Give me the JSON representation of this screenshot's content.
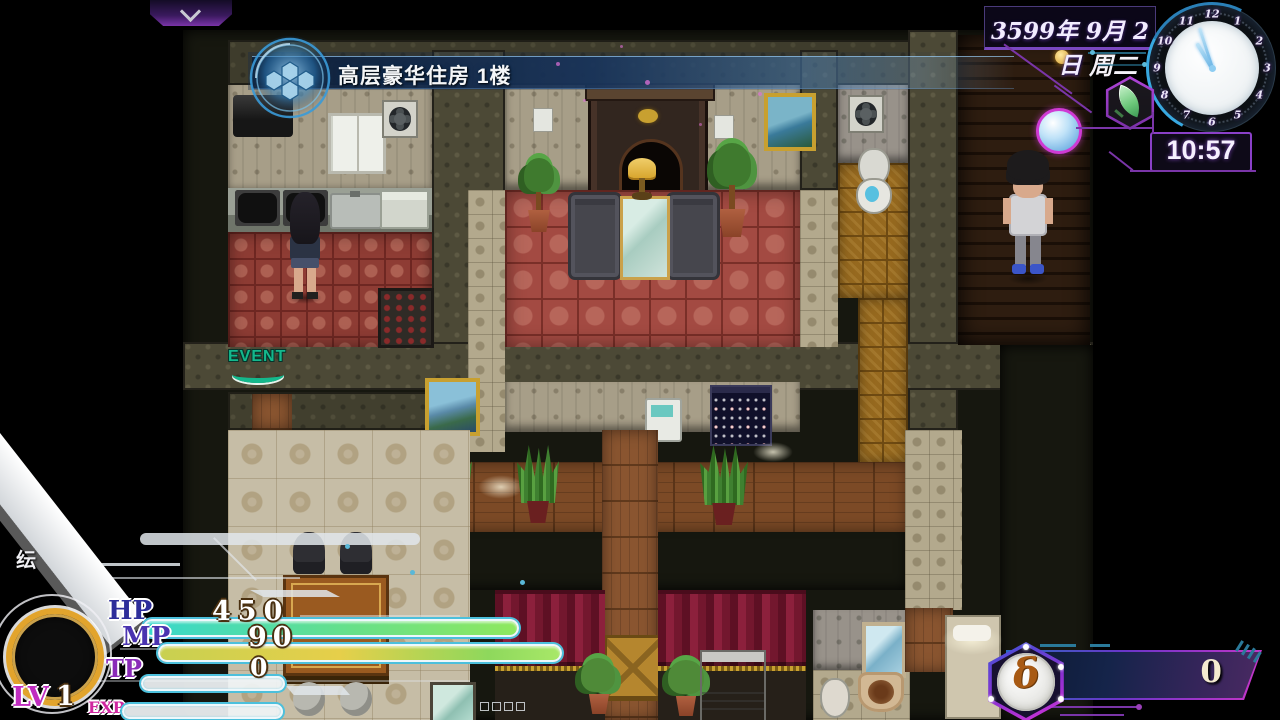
{
  "top_tab": {
    "icon": "chevron-down"
  },
  "location_banner": {
    "text": "高层豪华住房 1楼",
    "icon": "hex-globe-emblem"
  },
  "datetime_panel": {
    "date": "3599年 9月 2日",
    "weekday": "周二",
    "digital_time": "10:57",
    "clock": {
      "numbers": [
        "12",
        "1",
        "2",
        "3",
        "4",
        "5",
        "6",
        "7",
        "8",
        "9",
        "10",
        "11"
      ]
    },
    "weather_icon": "leaf",
    "sky_icon": "clear-sky-orb"
  },
  "status_hud": {
    "corner_glyph": "纭",
    "hp": {
      "label": "HP",
      "value": "450"
    },
    "mp": {
      "label": "MP",
      "value": "90"
    },
    "tp": {
      "label": "TP",
      "value": "0"
    },
    "level": {
      "label": "LV",
      "value": "1"
    },
    "exp": {
      "label": "EXP"
    }
  },
  "currency_hud": {
    "symbol": "δ",
    "amount": "0"
  },
  "map": {
    "event_sign_text": "EVENT"
  },
  "colors": {
    "accent_purple": "#8a40c8",
    "accent_magenta": "#cf3ad4",
    "accent_blue": "#38a8e0",
    "hp_bar_gradient": [
      "#38d8cc",
      "#8fe85e"
    ],
    "mp_bar_gradient": [
      "#c8d050",
      "#8ed85c"
    ],
    "banner_blue": "#18345c",
    "currency_text": "#f4ead0",
    "event_green": "#14b88c",
    "carpet_red": "#a34a42",
    "gold_ring": "#e2a42c"
  }
}
